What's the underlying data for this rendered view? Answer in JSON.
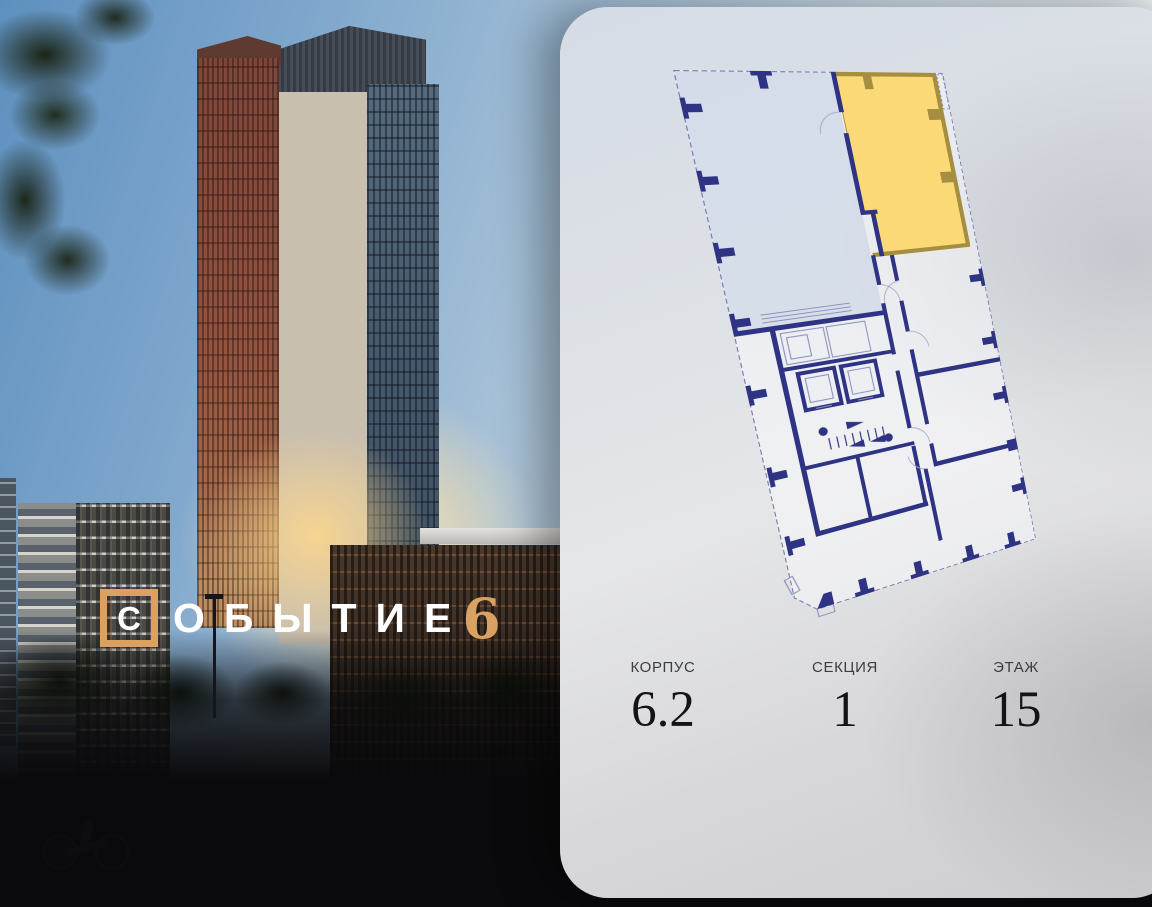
{
  "brand": {
    "first_letter": "С",
    "rest_letters": "ОБЫТИЕ",
    "number": "6"
  },
  "apartment": {
    "details": [
      {
        "label": "КОРПУС",
        "value": "6.2"
      },
      {
        "label": "СЕКЦИЯ",
        "value": "1"
      },
      {
        "label": "ЭТАЖ",
        "value": "15"
      }
    ]
  },
  "theme": {
    "accent": "#d9a263",
    "logo-text": "#ffffff",
    "plan-wall": "#2e3383",
    "plan-outline": "#7378ad",
    "hl-fill": "#fbd976",
    "hl-wall": "#a58e3f",
    "label-color": "#3c3d40",
    "value-color": "#141417"
  }
}
